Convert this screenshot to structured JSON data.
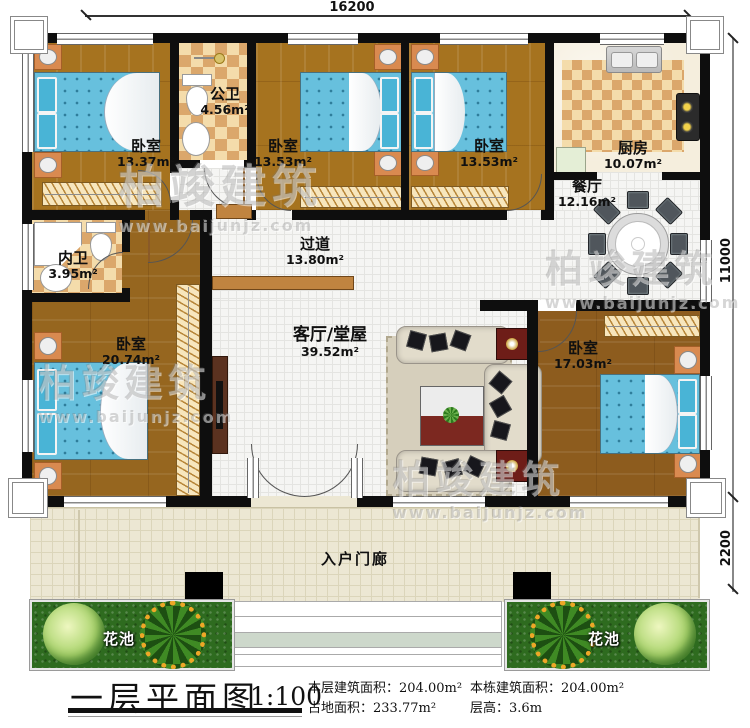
{
  "dimensions": {
    "top_width": "16200",
    "right_height": "11000",
    "porch_depth": "2200"
  },
  "rooms": {
    "bedroom_top_left": {
      "name": "卧室",
      "area": "13.37m²"
    },
    "public_bathroom": {
      "name": "公卫",
      "area": "4.56m²"
    },
    "bedroom_top_mid": {
      "name": "卧室",
      "area": "13.53m²"
    },
    "bedroom_top_right": {
      "name": "卧室",
      "area": "13.53m²"
    },
    "kitchen": {
      "name": "厨房",
      "area": "10.07m²"
    },
    "dining_room": {
      "name": "餐厅",
      "area": "12.16m²"
    },
    "inner_bathroom": {
      "name": "内卫",
      "area": "3.95m²"
    },
    "master_bedroom": {
      "name": "卧室",
      "area": "20.74m²"
    },
    "hallway": {
      "name": "过道",
      "area": "13.80m²"
    },
    "living_room": {
      "name": "客厅/堂屋",
      "area": "39.52m²"
    },
    "bedroom_right": {
      "name": "卧室",
      "area": "17.03m²"
    },
    "entry_porch": {
      "name": "入户门廊"
    },
    "flower_bed": {
      "name": "花池"
    }
  },
  "title_block": {
    "title": "一层平面图",
    "scale": "1:100",
    "stats": [
      {
        "label": "本层建筑面积：",
        "value": "204.00m²"
      },
      {
        "label": "占地面积：",
        "value": "233.77m²"
      },
      {
        "label": "本栋建筑面积：",
        "value": "204.00m²"
      },
      {
        "label": "层高：",
        "value": "3.6m"
      }
    ]
  },
  "watermark": {
    "brand": "柏竣建筑",
    "url": "www.baijunjz.com"
  },
  "colors": {
    "wall": "#0e0e0e",
    "wood_floor": "#a6731f",
    "tile_checker_light": "#f4dcab",
    "tile_checker_dark": "#dba76b",
    "bed_blue": "#67c0dd",
    "grass_green": "#2e6b1f",
    "porch_tile": "#ece7d3"
  }
}
